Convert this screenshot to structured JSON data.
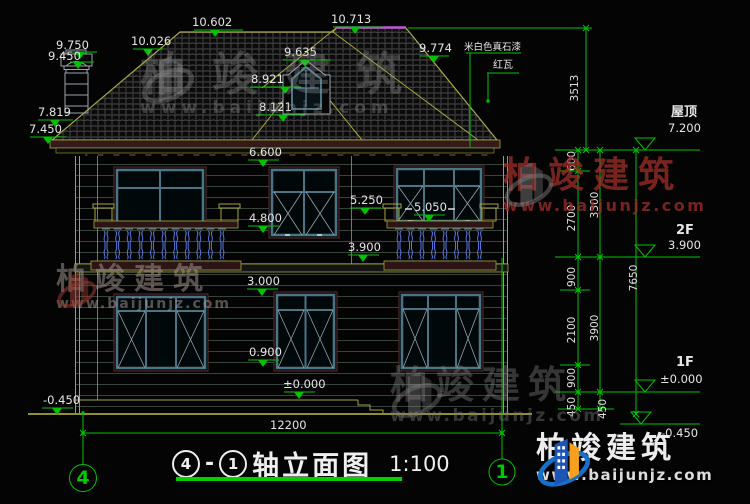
{
  "drawing": {
    "title": {
      "axis_from": "4",
      "axis_to": "1",
      "separator": "-",
      "name": "轴立面图",
      "scale": "1:100"
    },
    "axes": {
      "left": "4",
      "right": "1"
    },
    "notes": {
      "wall_finish": "米白色真石漆",
      "roof_tile": "红瓦"
    },
    "floors": {
      "roof": "屋顶",
      "f2": "2F",
      "f1": "1F"
    },
    "levels": {
      "chimney_top": "9.750",
      "chimney_cap": "9.450",
      "roof_break_left": "10.026",
      "ridge_left": "10.602",
      "ridge_right": "10.713",
      "dormer_peak": "9.635",
      "dormer_mid": "8.921",
      "dormer_sill": "8.121",
      "roof_break_right": "9.774",
      "eave_top": "7.819",
      "eave_bottom": "7.450",
      "eave": "6.600",
      "sill_2f": "4.800",
      "rail_center": "5.250",
      "rail_right": "5.050",
      "floor2": "3.900",
      "head_1f": "3.000",
      "sill_1f": "0.900",
      "floor1": "±0.000",
      "grade_left": "-0.450",
      "roof_level": "7.200",
      "floor2_level": "3.900",
      "floor1_level": "±0.000",
      "grade_right": "-0.450"
    },
    "dims": {
      "total_width": "12200",
      "roof_rise": "3513",
      "total_height": "7650",
      "c600": "600",
      "c2700": "2700",
      "c3300": "3300",
      "c900a": "900",
      "c2100": "2100",
      "c3900": "3900",
      "c900b": "900",
      "c450a": "450",
      "c450b": "450"
    },
    "watermark": {
      "name": "柏竣建筑",
      "url": "www.baijunjz.com"
    }
  }
}
